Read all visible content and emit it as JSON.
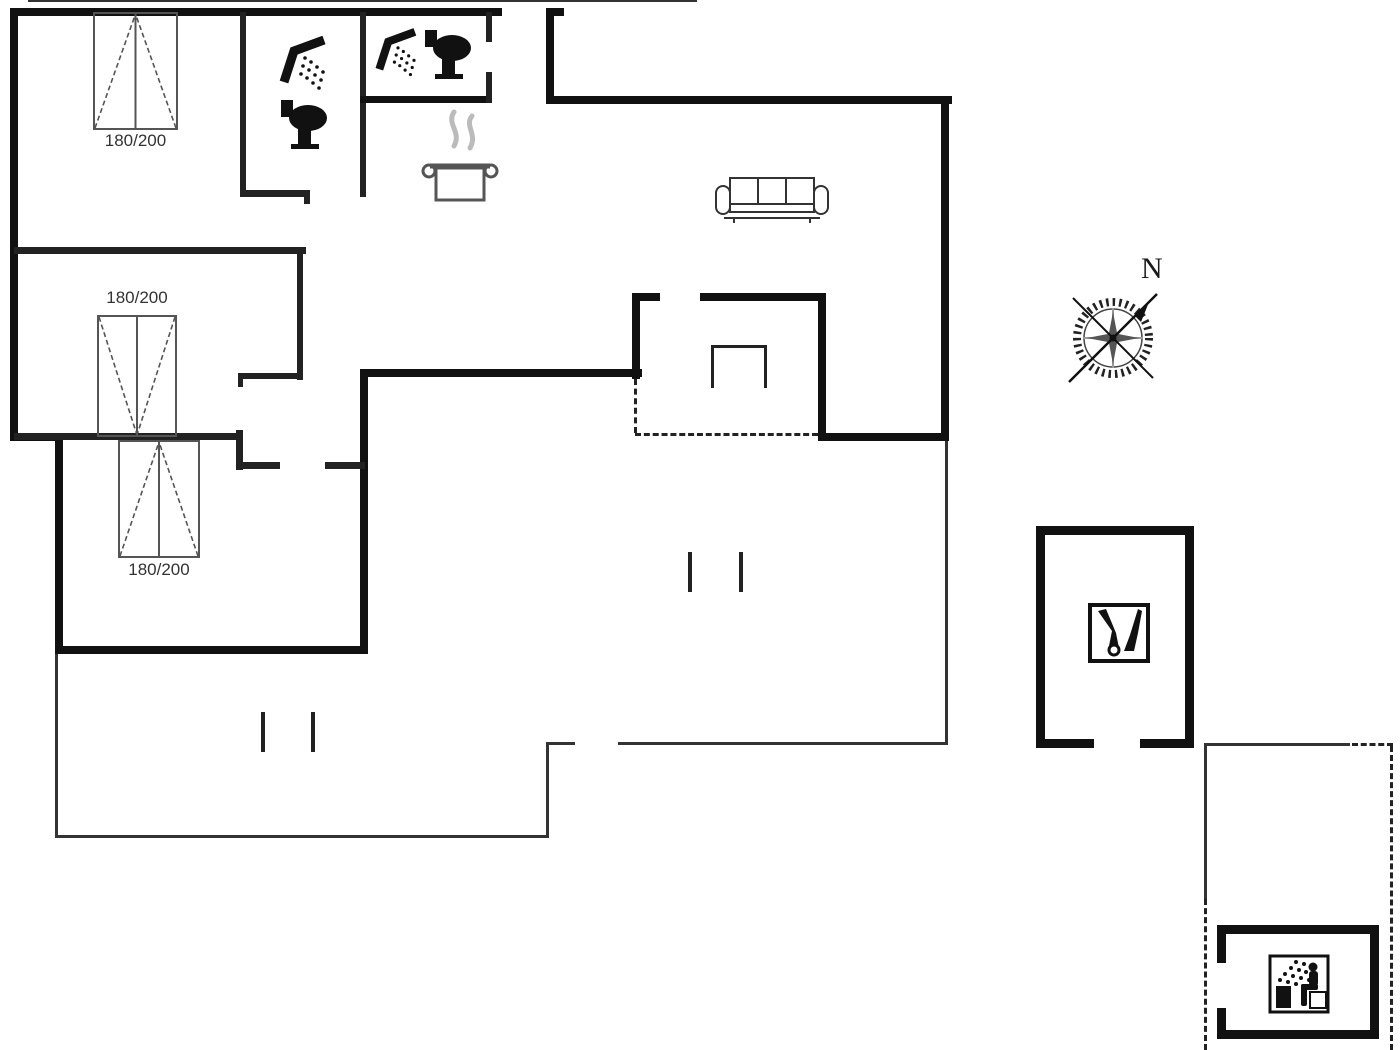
{
  "plan": {
    "type": "holiday-house-floor-plan",
    "beds": [
      {
        "label": "180/200"
      },
      {
        "label": "180/200"
      },
      {
        "label": "180/200"
      }
    ],
    "compass": {
      "label": "N",
      "needle_direction": "north-east"
    },
    "colors": {
      "wall": "#111111",
      "interior_wall": "#222222",
      "thin_line": "#333333",
      "bed_line": "#555555",
      "steam": "#bbbbbb",
      "background": "#ffffff"
    },
    "icons": {
      "bathroom1": [
        "shower-icon",
        "toilet-icon"
      ],
      "bathroom2": [
        "shower-icon",
        "toilet-icon"
      ],
      "kitchen": [
        "cooking-pot-icon"
      ],
      "living_room": [
        "sofa-icon",
        "fireplace-icon"
      ],
      "outbuilding_right": [
        "garden-tools-icon"
      ],
      "outbuilding_sauna": [
        "sauna-icon"
      ],
      "compass": [
        "compass-rose-icon"
      ]
    }
  }
}
